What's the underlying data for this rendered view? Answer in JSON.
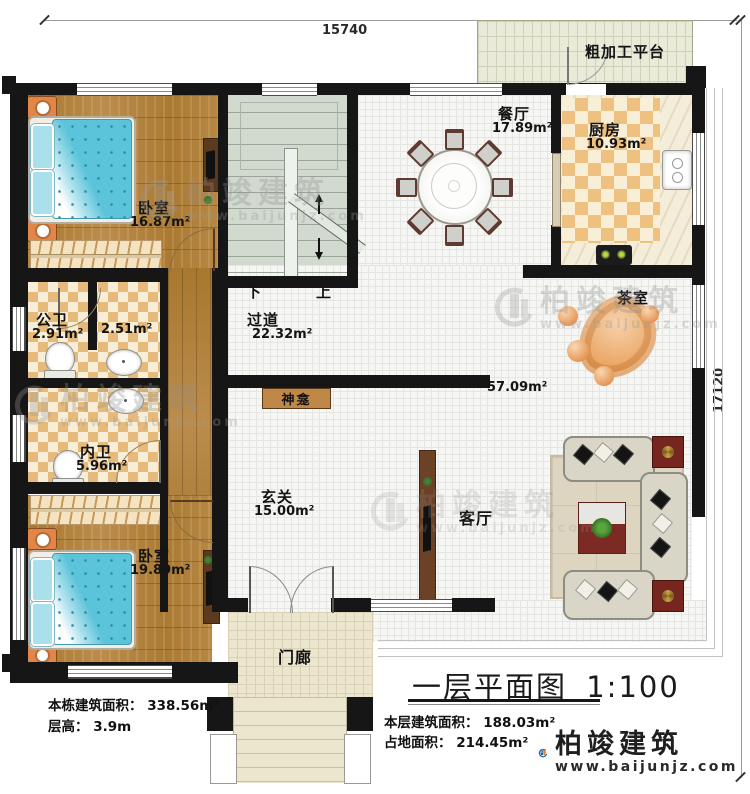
{
  "dimensions": {
    "top": "15740",
    "right": "17120"
  },
  "rooms": {
    "bedroom1": {
      "name": "卧室",
      "area": "16.87m²"
    },
    "dining": {
      "name": "餐厅",
      "area": "17.89m²"
    },
    "kitchen": {
      "name": "厨房",
      "area": "10.93m²"
    },
    "platform": {
      "name": "粗加工平台"
    },
    "corridor": {
      "name": "过道",
      "area": "22.32m²"
    },
    "public_bath": {
      "name": "公卫",
      "area": "2.91m²"
    },
    "washroom": {
      "area": "2.51m²"
    },
    "inner_bath": {
      "name": "内卫",
      "area": "5.96m²"
    },
    "foyer": {
      "name": "玄关",
      "area": "15.00m²"
    },
    "living": {
      "name": "客厅",
      "area": "57.09m²"
    },
    "tea_room": {
      "name": "茶室"
    },
    "shrine": {
      "name": "神龛"
    },
    "bedroom2": {
      "name": "卧室",
      "area": "19.89m²"
    },
    "porch": {
      "name": "门廊"
    },
    "stairs": {
      "down": "下",
      "up": "上"
    }
  },
  "title": {
    "main": "一层平面图",
    "scale": "1:100"
  },
  "notes": {
    "building_area": "本栋建筑面积： 338.56m²",
    "floor_height": "层高： 3.9m",
    "level_area": "本层建筑面积： 188.03m²",
    "footprint": "占地面积： 214.45m²"
  },
  "brand": {
    "name": "柏竣建筑",
    "site": "www.baijunjz.com"
  },
  "watermark": {
    "name": "柏竣建筑",
    "site": "www.baijunjz.com"
  },
  "colors": {
    "wall": "#161616",
    "wood_floor": "#b0803e",
    "bed_blue": "#5cc4da",
    "checker_tan": "#eec180",
    "stair_green": "#d2dad0",
    "logo_blue": "#1b5ea6",
    "logo_orange": "#f08218",
    "shrine_brown": "#c08848"
  }
}
